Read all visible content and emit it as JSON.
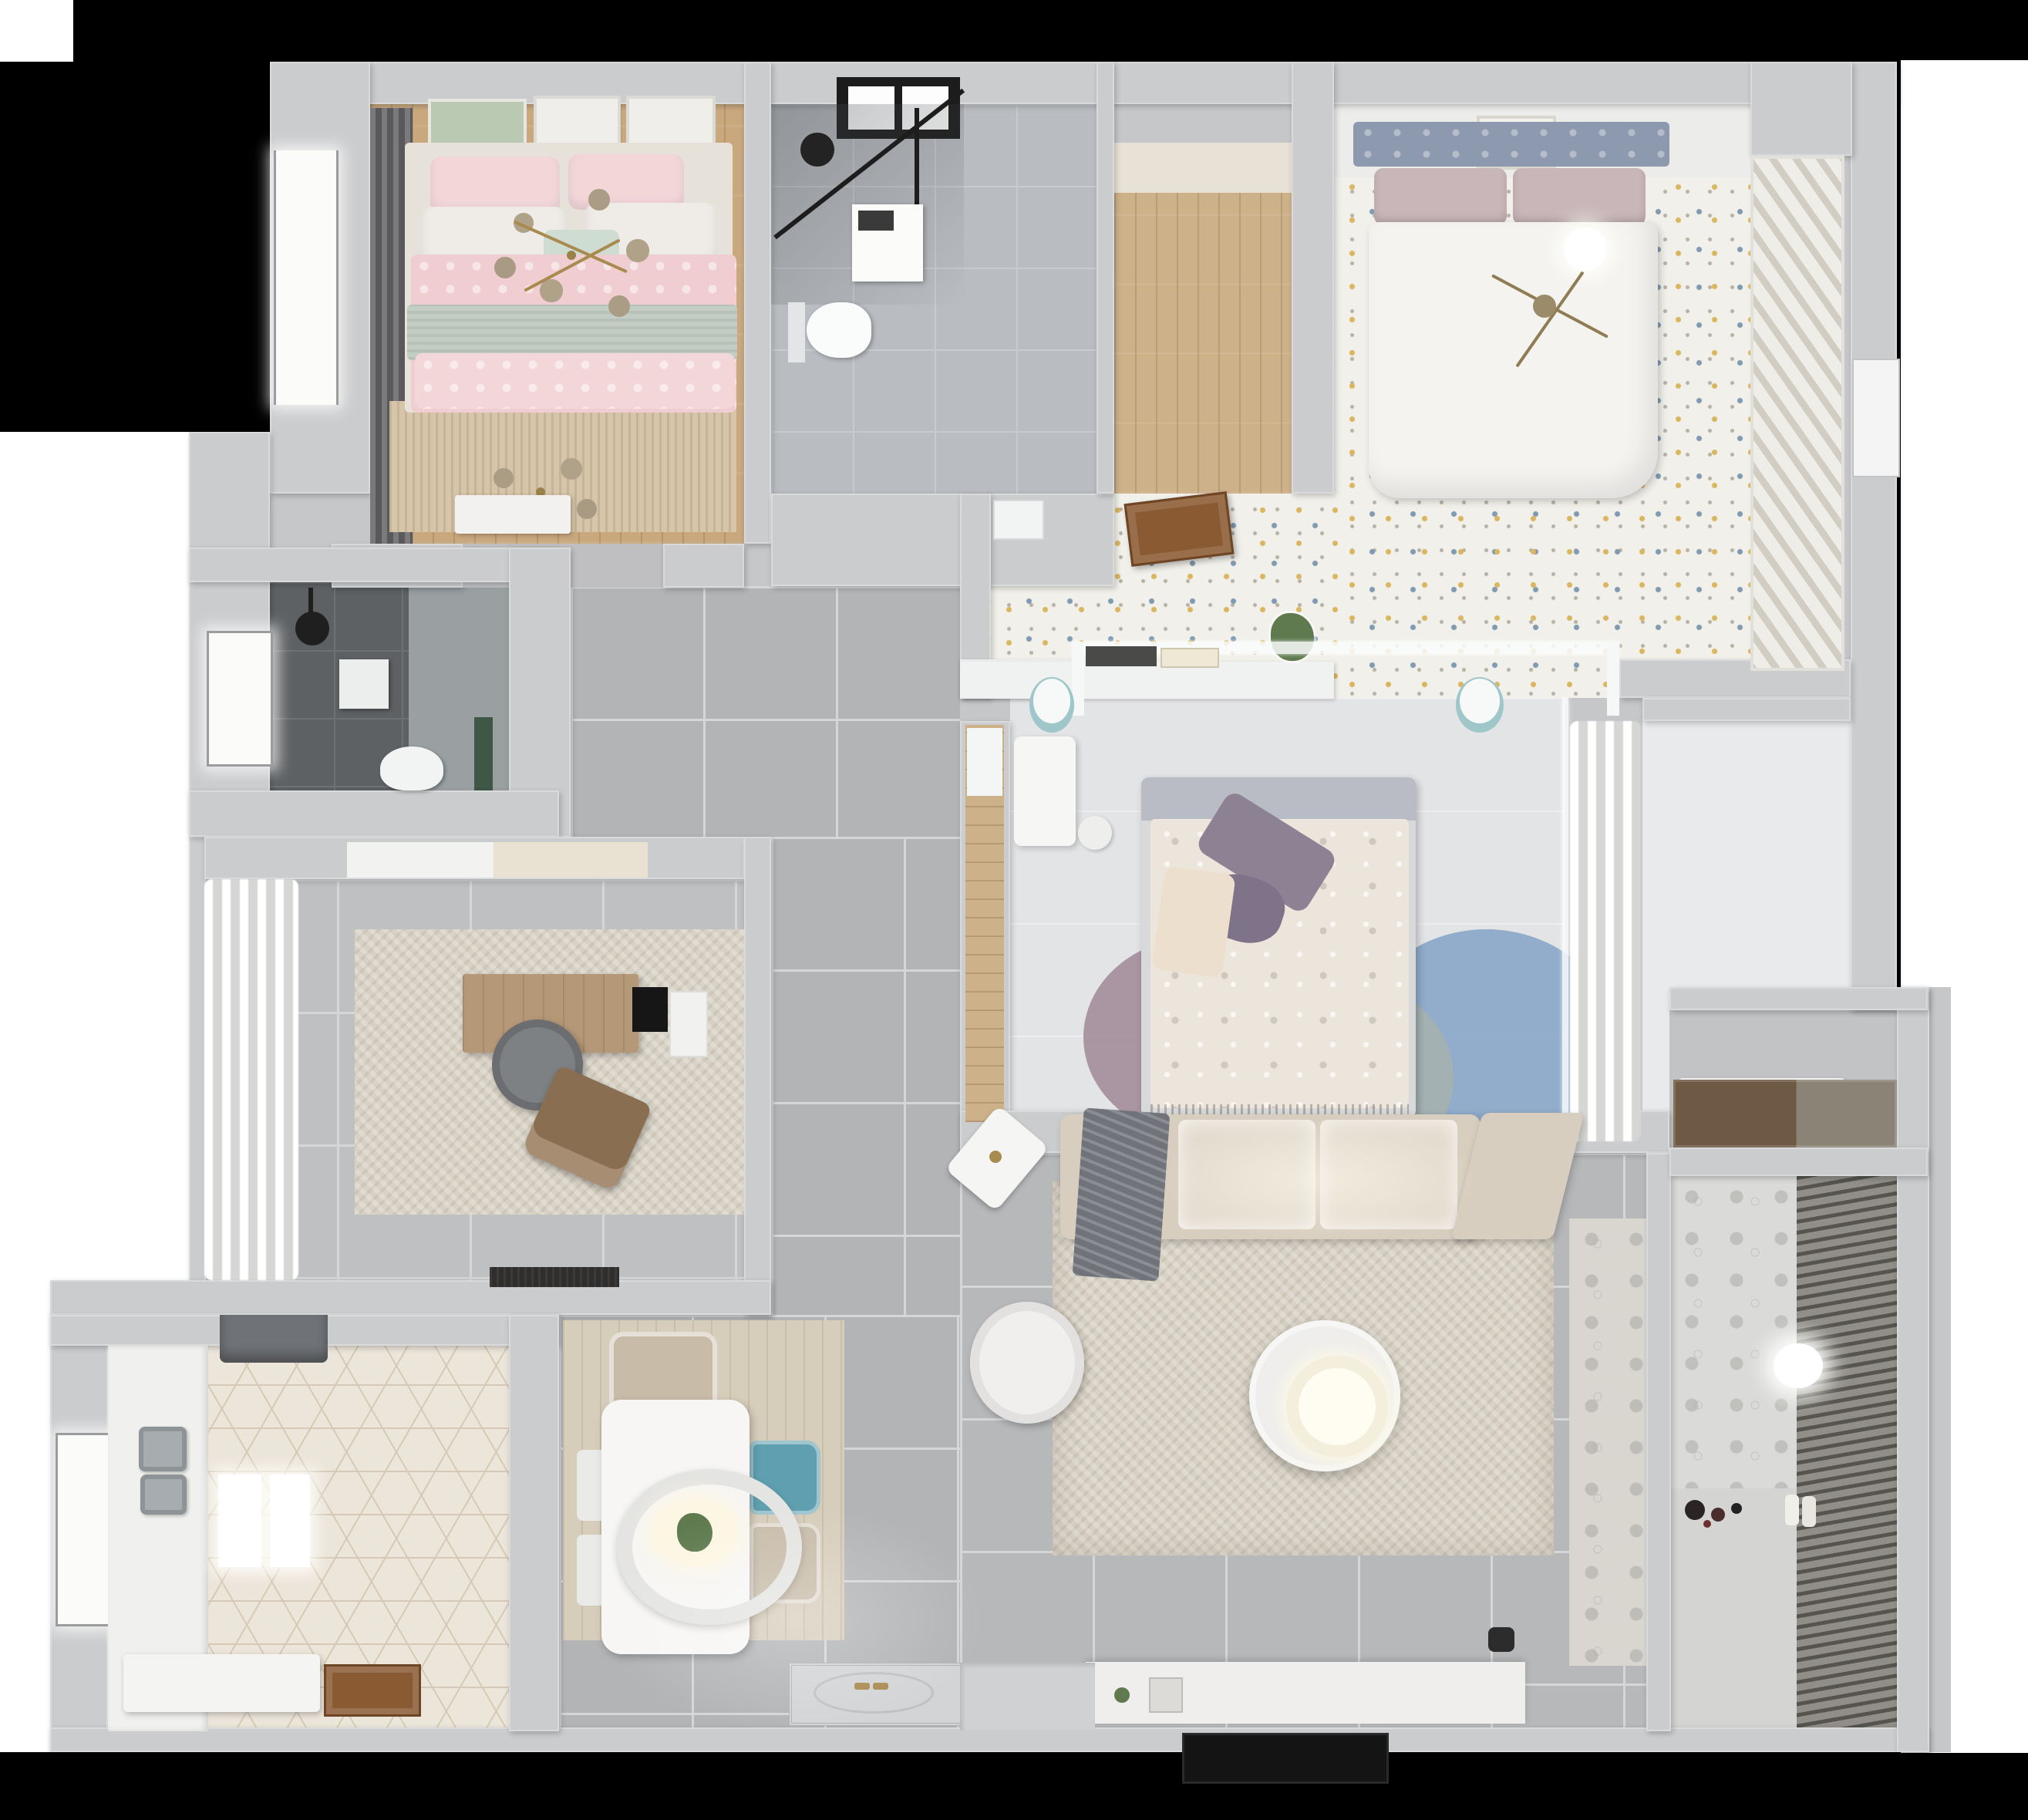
{
  "meta": {
    "title": "apartment-3d-floor-plan-top-view",
    "style": "photoreal render recreated as stylized plan"
  },
  "palette": {
    "bg": "#000000",
    "outside": "#ffffff",
    "wall": "#cbccce",
    "wall_light": "#e8e9eb",
    "wall_dark": "#b3b4b6",
    "wood_warm": "#c9a87e",
    "wood_light": "#cdb189",
    "wood_door": "#8a5a33",
    "wood_counter": "#6d5944",
    "tile_bath": "#b9bcc0",
    "tile_dark": "#5e6164",
    "tile_corridor": "#b2b4b6",
    "tile_study": "#bfc0c2",
    "tile_living": "#b6b8ba",
    "tile_balcony": "#d4d4d2",
    "tile_entry": "#d3d4d6",
    "floor_bedroom1": "#f2f0ea",
    "floor_bedroom3": "#e3e4e6",
    "floor_hall_right": "#e9eaec",
    "rug_bed2": "#d6c5a8",
    "rug_study": "#d8d2c5",
    "rug_living": "#d8d1c4",
    "rug_dining_wood": "#d7cdbb",
    "pink": "#efcdd0",
    "pink_light": "#f2d6d8",
    "sage": "#c2cdc3",
    "mint": "#cfdcd2",
    "headboard_blue": "#8d99ae",
    "mauve": "#c9b6b8",
    "duvet_white": "#f4f3f0",
    "duvet_cream": "#ece5dc",
    "purple": "#8d8194",
    "purple_dark": "#7e7389",
    "teal": "#9fc6c9",
    "teal_chair": "#5f9fb0",
    "beige_chair": "#c8bca9",
    "sofa": "#d8cec0",
    "sofa_light": "#e4dbce",
    "throw": "#70747a",
    "armchair": "#f0efed",
    "coffee_white": "#efeeec",
    "glow": "#fdf6e3",
    "console": "#efeeec",
    "tv": "#141414",
    "gold": "#a98a4f",
    "glass_bulb": "#b3a48d",
    "rug_blue": "#82a3c6",
    "rug_mauve": "#a08896",
    "rug_sage": "#a9b2ab",
    "counter_white": "#f0f0ee",
    "steel": "#a7acb0",
    "hood": "#6f7276",
    "green_plant": "#5e7a4e",
    "curtain_dark": "#6b6b6d",
    "desk_wood": "#b59877",
    "chair_gray": "#7e8184",
    "lounge_brown": "#8a6e51",
    "mat_black": "#2e2e2e",
    "green_accent": "#3f5747"
  },
  "rooms": [
    {
      "id": "bedroom-pink",
      "label": "bedroom with pink bed",
      "floor": "wood_warm"
    },
    {
      "id": "bathroom-main",
      "label": "bathroom with shower and toilet",
      "floor": "tile_bath"
    },
    {
      "id": "closet-room",
      "label": "walk-in closet with wood floor",
      "floor": "wood_light"
    },
    {
      "id": "bedroom-master",
      "label": "master bedroom with white bed",
      "floor": "floor_bedroom1"
    },
    {
      "id": "bathroom-dark",
      "label": "dark tiled shower room",
      "floor": "tile_dark"
    },
    {
      "id": "study",
      "label": "study with desk and chair",
      "floor": "tile_study"
    },
    {
      "id": "bedroom-center",
      "label": "center bedroom with glass partition",
      "floor": "floor_bedroom3"
    },
    {
      "id": "hallway",
      "label": "corridor with large gray tiles",
      "floor": "tile_corridor"
    },
    {
      "id": "kitchen",
      "label": "kitchen with hexagon tile floor",
      "floor": "counter_white"
    },
    {
      "id": "dining",
      "label": "dining area with table and chairs",
      "floor": "rug_dining_wood"
    },
    {
      "id": "living",
      "label": "living room with sofa and round coffee table",
      "floor": "tile_living"
    },
    {
      "id": "storage-niche",
      "label": "storage niche with wood counter",
      "floor": "wood_counter"
    },
    {
      "id": "balcony",
      "label": "balcony with venetian blinds",
      "floor": "tile_balcony"
    }
  ],
  "furniture": {
    "bedroom_pink": [
      "double-bed-pink",
      "branch-chandelier-gold",
      "wall-art-frames",
      "window-curtains",
      "foot-bench"
    ],
    "bathroom_main": [
      "black-frame-shower",
      "wall-hung-toilet",
      "vanity-unit",
      "black-window"
    ],
    "bedroom_master": [
      "tufted-headboard-bed",
      "gold-ceiling-fan",
      "pendant-ball-lamp",
      "slatted-wardrobe",
      "open-wood-door",
      "ac-vent",
      "plant-on-ledge",
      "picture-frame"
    ],
    "bathroom_dark": [
      "rain-shower-head",
      "toilet",
      "wall-shelf",
      "window",
      "floral-accent-wall"
    ],
    "study": [
      "wood-desk",
      "monitor",
      "round-office-chair",
      "lounge-chair",
      "side-cabinet",
      "door-mat",
      "curtain-wall"
    ],
    "bedroom_center": [
      "bed-floral-duvet",
      "purple-pillows",
      "glass-partition-with-books",
      "teal-side-tables",
      "white-desk",
      "round-rug-circles",
      "curtain-glass-wall",
      "wardrobe-niche"
    ],
    "kitchen": [
      "double-steel-sink",
      "range-hood",
      "counter",
      "island-slab",
      "wood-entry-mat",
      "window"
    ],
    "dining": [
      "white-dining-table",
      "ring-pendant-lamp",
      "teal-chair",
      "beige-chairs",
      "wood-look-rug"
    ],
    "living": [
      "l-shaped-sofa",
      "gray-throw",
      "round-coffee-table",
      "white-armchair",
      "side-table",
      "tv-console",
      "tv-panel",
      "area-rug",
      "entry-medallion"
    ],
    "balcony": [
      "venetian-blinds",
      "ball-lamp",
      "toys",
      "paper-rolls",
      "patterned-wall"
    ]
  }
}
